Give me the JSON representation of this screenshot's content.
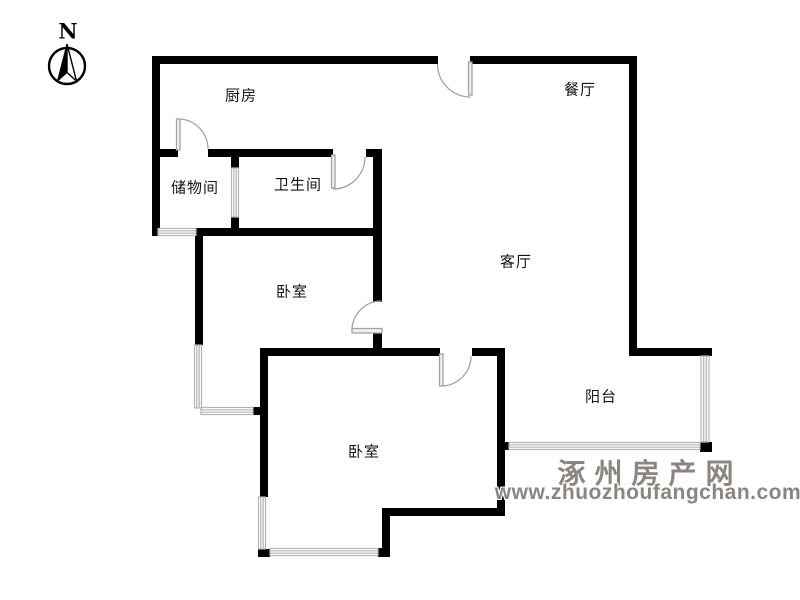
{
  "compass": {
    "label": "N"
  },
  "rooms": [
    {
      "id": "kitchen",
      "label": "厨房"
    },
    {
      "id": "dining",
      "label": "餐厅"
    },
    {
      "id": "storage",
      "label": "储物间"
    },
    {
      "id": "bathroom",
      "label": "卫生间"
    },
    {
      "id": "bedroom-1",
      "label": "卧室"
    },
    {
      "id": "living",
      "label": "客厅"
    },
    {
      "id": "bedroom-2",
      "label": "卧室"
    },
    {
      "id": "balcony",
      "label": "阳台"
    }
  ],
  "watermark": {
    "site_name": "涿州房产网",
    "site_url": "www.zhuozhoufangchan.com"
  },
  "colors": {
    "wall": "#000000",
    "door": "#a3a3a3",
    "door_leaf_fill": "#efefef",
    "window": "#b3b3b3",
    "watermark": "#8b8580",
    "background": "#ffffff",
    "label": "#141414"
  }
}
